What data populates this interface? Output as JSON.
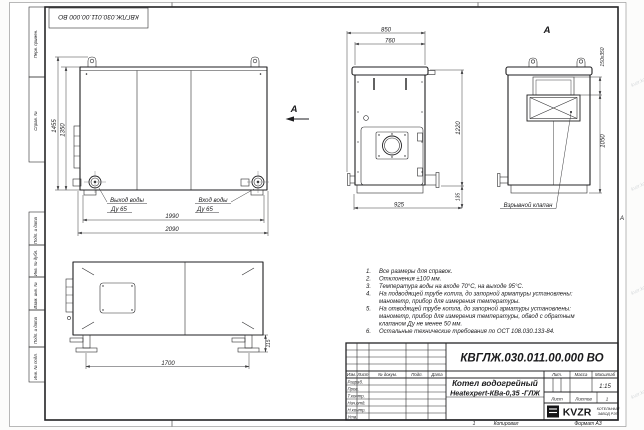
{
  "sheet": {
    "top_stamp": "КВГЛЖ.030.011.00.000 ВО",
    "copied": "Копировал",
    "format": "Формат А3",
    "zone_letter": "А",
    "zone_number": "1",
    "watermark": "kvzr.kz"
  },
  "margins": {
    "left_top": [
      "Перв. примен.",
      "Справ. №"
    ],
    "left_bottom": [
      "Подп. и дата",
      "Инв. № дубл.",
      "Взам. инв. №",
      "Подп. и дата",
      "Инв. № подл."
    ]
  },
  "views": {
    "front": {
      "h_outer": "1455",
      "h_inner": "1350",
      "w_inner": "1990",
      "w_outer": "2090",
      "outlet": "Выход воды",
      "outlet_dn": "Ду 65",
      "inlet": "Вход воды",
      "inlet_dn": "Ду 65",
      "arrow": "А"
    },
    "side_front": {
      "w_outer": "850",
      "w_inner": "760",
      "h": "1220",
      "w_base": "925",
      "h_base": "135"
    },
    "rear": {
      "label": "А",
      "duct": "150х350",
      "h": "1050",
      "callout": "Взрывной клапан"
    },
    "side": {
      "w": "1700",
      "h_base": "115"
    }
  },
  "notes": [
    {
      "n": "1.",
      "t": "Все размеры для справок."
    },
    {
      "n": "2.",
      "t": "Отклонения ±100 мм."
    },
    {
      "n": "3.",
      "t": "Температура воды на входе 70°С, на выходе 95°С."
    },
    {
      "n": "4.",
      "t": "На подводящей трубе котла, до запорной арматуры установлены:"
    },
    {
      "n": "",
      "t": "манометр, прибор для измерения температуры."
    },
    {
      "n": "5.",
      "t": "На отводящей трубе котла, до запорной арматуры установлены:"
    },
    {
      "n": "",
      "t": "манометр, прибор для измерения температуры, обвод с обратным"
    },
    {
      "n": "",
      "t": "клапаном Ду не менее 50 мм."
    },
    {
      "n": "6.",
      "t": "Остальные технические требования по ОСТ 108.030.133-84."
    }
  ],
  "title_block": {
    "doc_number": "КВГЛЖ.030.011.00.000 ВО",
    "product_line1": "Котел водогрейный",
    "product_line2": "Heatexpert-КВа-0,35 -ГЛЖ",
    "header_cols": [
      "Изм.",
      "Лист",
      "№ докум.",
      "Подп.",
      "Дата"
    ],
    "sig_rows": [
      "Разраб.",
      "Пров.",
      "Т.контр.",
      "Нач.отд.",
      "Н.контр.",
      "Утв."
    ],
    "lit_label": "Лит.",
    "mass_label": "Масса",
    "scale_label": "Масштаб",
    "scale_value": "1:15",
    "sheet_label": "Лист",
    "sheets_label": "Листов",
    "sheets_value": "1",
    "logo_text": "KVZR",
    "factory_line1": "КОТЕЛЬНЫЙ",
    "factory_line2": "ЗАВОД РЭП"
  }
}
